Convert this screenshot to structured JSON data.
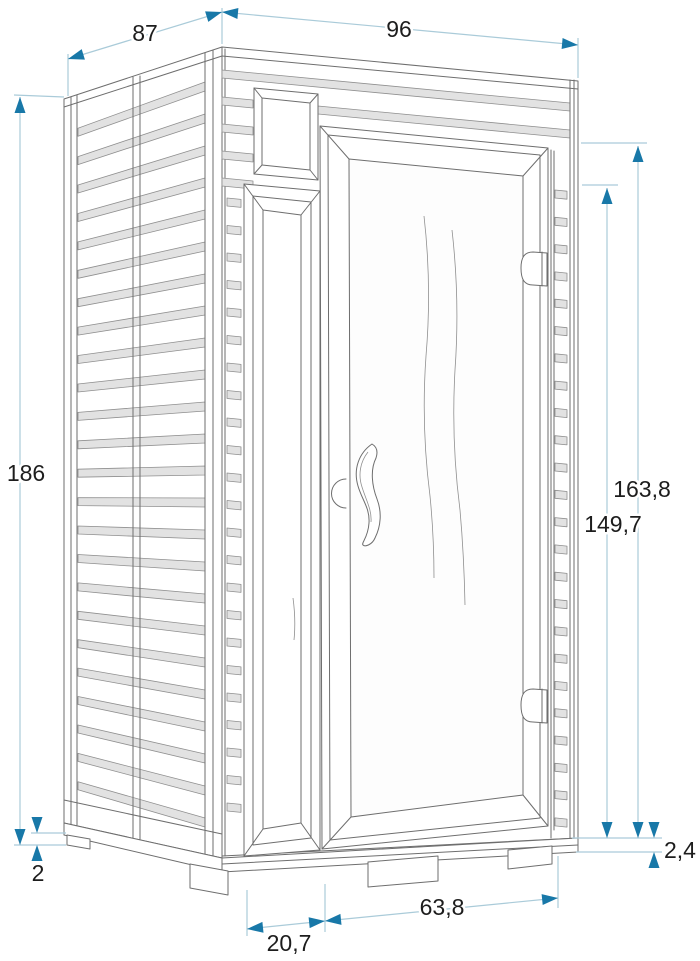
{
  "page": {
    "background": "#ffffff",
    "type": "technical-dimension-drawing",
    "subject": "sauna cabin with louvered side wall and glass door, three-quarter perspective view"
  },
  "style": {
    "outline_color": "#6e6e6e",
    "slat_fill": "#e2e2e2",
    "dimension_line_color": "#aacbd9",
    "dimension_arrow_color": "#1878a8",
    "dimension_text_color": "#1d1d1d"
  },
  "dimensions": {
    "depth_top": "87",
    "width_top": "96",
    "height_total": "186",
    "height_right_outer": "163,8",
    "height_right_inner": "149,7",
    "base_height_left": "2",
    "base_height_right": "2,4",
    "door_width_bottom": "63,8",
    "door_offset_bottom": "20,7"
  }
}
